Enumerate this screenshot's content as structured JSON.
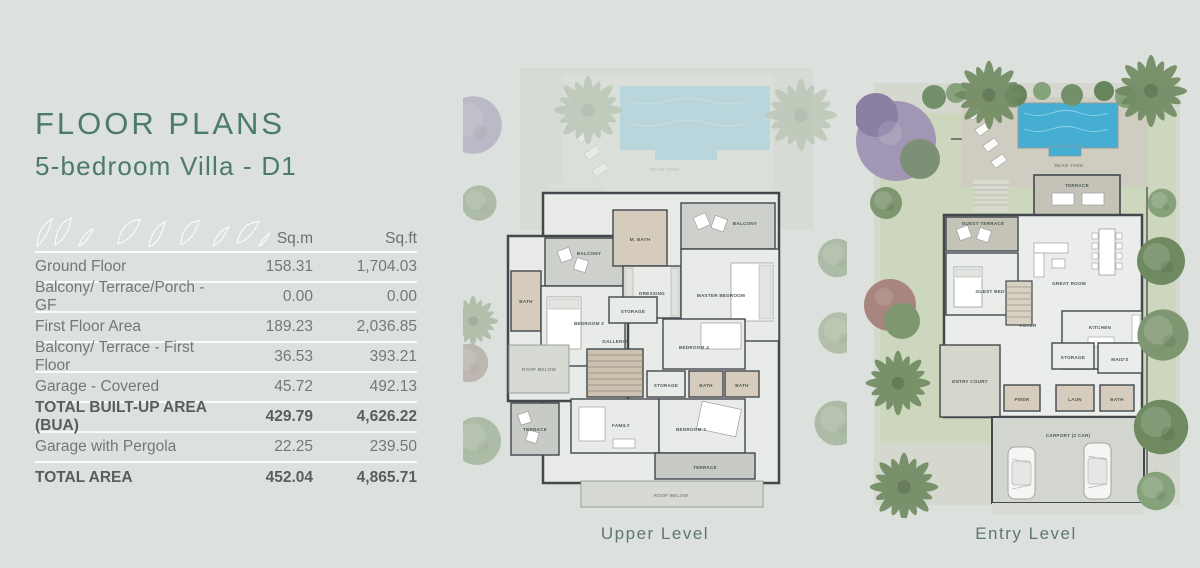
{
  "header": {
    "title": "FLOOR PLANS",
    "subtitle": "5-bedroom Villa - D1"
  },
  "table": {
    "columns": {
      "sqm": "Sq.m",
      "sqft": "Sq.ft"
    },
    "rows": [
      {
        "label": "Ground Floor",
        "sqm": "158.31",
        "sqft": "1,704.03"
      },
      {
        "label": "Balcony/ Terrace/Porch - GF",
        "sqm": "0.00",
        "sqft": "0.00"
      },
      {
        "label": "First Floor Area",
        "sqm": "189.23",
        "sqft": "2,036.85"
      },
      {
        "label": "Balcony/ Terrace - First Floor",
        "sqm": "36.53",
        "sqft": "393.21"
      },
      {
        "label": "Garage - Covered",
        "sqm": "45.72",
        "sqft": "492.13"
      },
      {
        "label": "TOTAL BUILT-UP AREA (BUA)",
        "sqm": "429.79",
        "sqft": "4,626.22"
      },
      {
        "label": "Garage with Pergola",
        "sqm": "22.25",
        "sqft": "239.50"
      },
      {
        "label": "TOTAL AREA",
        "sqm": "452.04",
        "sqft": "4,865.71"
      }
    ]
  },
  "plans": {
    "upper": {
      "caption": "Upper Level",
      "labels": {
        "rear_yard": "REAR YARD",
        "balcony_left": "BALCONY",
        "bath_left": "BATH",
        "bedroom2": "BEDROOM 2",
        "m_bath": "M. BATH",
        "dressing": "DRESSING",
        "balcony_right": "BALCONY",
        "master_bedroom": "MASTER BEDROOM",
        "storage1": "STORAGE",
        "galleria": "GALLERIA",
        "roof_below_left": "ROOF BELOW",
        "bedroom4": "BEDROOM 4",
        "storage2": "STORAGE",
        "bath4": "BATH",
        "bath3": "BATH",
        "bedroom3": "BEDROOM 3",
        "family": "FAMILY",
        "terrace_left": "TERRACE",
        "terrace_bottom": "TERRACE",
        "roof_below_bottom": "ROOF BELOW"
      }
    },
    "entry": {
      "caption": "Entry Level",
      "labels": {
        "rear_yard": "REAR YARD",
        "terrace": "TERRACE",
        "guest_terrace": "GUEST TERRACE",
        "great_room": "GREAT ROOM",
        "guest_bed": "GUEST BED",
        "foyer": "FOYER",
        "kitchen": "KITCHEN",
        "storage": "STORAGE",
        "maids": "MAID'S",
        "entry_court": "ENTRY COURT",
        "powder": "PWDR",
        "laundry": "LAUN",
        "bath": "BATH",
        "carport": "CARPORT (2 CAR)"
      }
    }
  },
  "colors": {
    "background": "#dce1de",
    "title_green": "#4c7a6b",
    "pool_blue": "#46aed2",
    "caption_green": "#5e7870"
  }
}
